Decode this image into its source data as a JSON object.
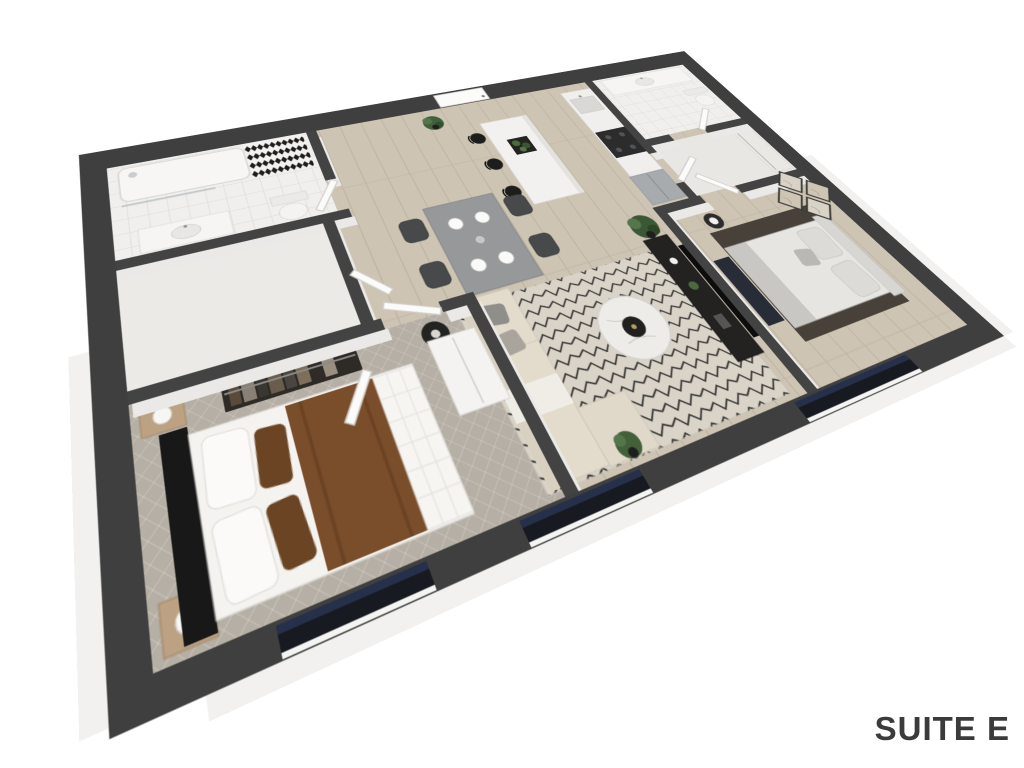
{
  "page": {
    "background": "#ffffff",
    "label": "SUITE E"
  },
  "palette": {
    "wall": "#3f3f3f",
    "interior_wall": "#434343",
    "wall_face": "#eae9e7",
    "wood_floor": "#cec4b4",
    "carpet": "#b5afa5",
    "tile": "#f0efed",
    "rug_living": "#d9d3c8",
    "rug_lines": "#2e2d2b",
    "rug_bedroom2": "#474139",
    "bed_brown": "#7a4e2b",
    "bed_white": "#f6f5f2",
    "headboard_black": "#181818",
    "sofa_beige": "#ded6c7",
    "pillow_gray": "#8f8e8a",
    "tv_black": "#0d0d0d",
    "console_black": "#232220",
    "bench_navy": "#282c36",
    "steel_fridge": "#a7abae",
    "stove_black": "#2c2c2c",
    "marble": "#edece8",
    "plant_green": "#42603a",
    "window_glass": "#171a21",
    "window_navy": "#26304b",
    "slab_white": "#f2f1ef",
    "label_color": "#3b3b3b"
  },
  "floorplan": {
    "suite": "SUITE E",
    "view": "3d-isometric-render",
    "rooms": [
      {
        "name": "bathroom-1",
        "furniture": [
          "bathtub-shower",
          "patterned-accent-tile",
          "vanity-sink",
          "toilet"
        ]
      },
      {
        "name": "storage-laundry",
        "furniture": []
      },
      {
        "name": "bedroom-1",
        "furniture": [
          "double-bed-brown-white",
          "black-headboard",
          "closet-with-clothes",
          "nightstand-lamp-x2",
          "white-wardrobe"
        ]
      },
      {
        "name": "entry-hall",
        "furniture": [
          "front-door",
          "potted-plant"
        ]
      },
      {
        "name": "kitchen",
        "furniture": [
          "island-with-planter",
          "bar-stools-x3",
          "counter-sink",
          "stove",
          "fridge"
        ]
      },
      {
        "name": "dining",
        "furniture": [
          "table",
          "chairs-x4",
          "place-settings-x4",
          "floor-lamp"
        ]
      },
      {
        "name": "living",
        "furniture": [
          "sectional-sofa",
          "zigzag-rug",
          "marble-coffee-table",
          "tv-console",
          "wall-tv",
          "fiddle-leaf-plant-x2"
        ]
      },
      {
        "name": "bathroom-2",
        "furniture": [
          "vanity-sink",
          "toilet"
        ]
      },
      {
        "name": "walk-in-closet",
        "furniture": [
          "shelving"
        ]
      },
      {
        "name": "bedroom-2",
        "furniture": [
          "bed-gray",
          "dark-area-rug",
          "bench",
          "side-table-lamp",
          "gallery-wall-art-x4"
        ]
      }
    ],
    "windows": 3
  }
}
